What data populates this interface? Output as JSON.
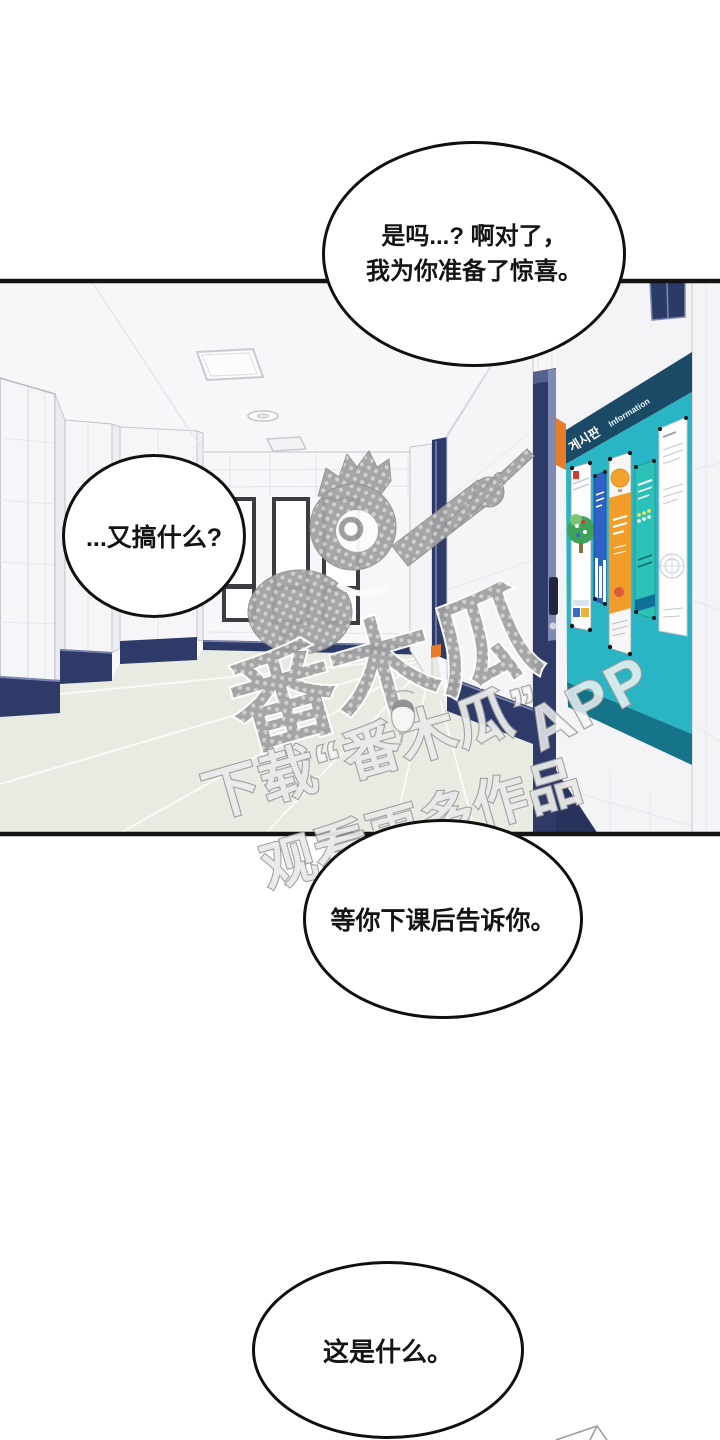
{
  "comic": {
    "bubbles": {
      "top": {
        "line1": "是吗...? 啊对了，",
        "line2": "我为你准备了惊喜。"
      },
      "left": {
        "text": "...又搞什么?"
      },
      "middle": {
        "text": "等你下课后告诉你。"
      },
      "bottom": {
        "text": "这是什么。"
      }
    },
    "watermark": {
      "big_text": "番木瓜",
      "download_line": "下载“番木瓜”",
      "app_text": "APP",
      "watch_line": "观看更多作品",
      "gray": "#a2a2a2"
    },
    "board": {
      "header_kr": "게시판",
      "header_en": "Information",
      "teal": "#2ab5c4",
      "header_bg": "#1b4a67",
      "bottom_band": "#15748a",
      "accent_orange": "#e87c28"
    },
    "scene": {
      "navy": "#2e3b69",
      "floor": "#e7ebe2",
      "wall": "#f5f5f7",
      "exit_green": "#2f9e5a"
    }
  }
}
